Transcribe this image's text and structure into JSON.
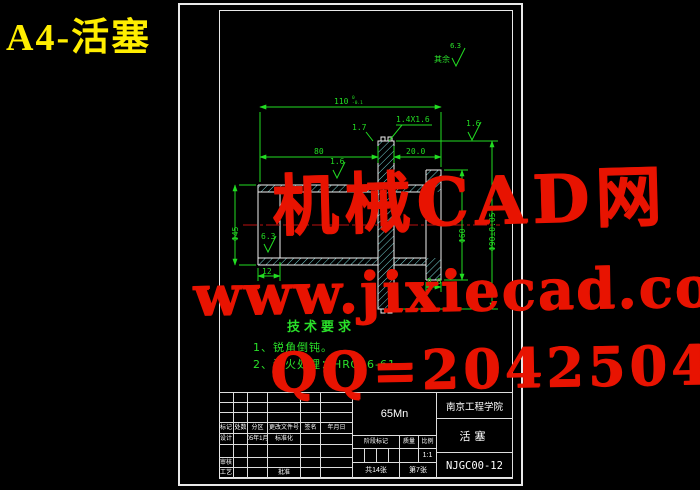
{
  "sheet_label": "A4-活塞",
  "corner_note": {
    "rest_label": "其余",
    "rest_value": "6.3"
  },
  "dimensions": {
    "overall": "110",
    "overall_tol_up": "0",
    "overall_tol_dn": "-0.1",
    "left_length": "80",
    "right_length": "20.0",
    "groove_depth": "1.7",
    "chamfer": "1.4X1.6",
    "od_left": "Φ45",
    "od_right": "Φ60",
    "od_flange": "Φ90±0.05",
    "end_width": "12",
    "ring_width": "8.0",
    "ra_top": "1.6",
    "ra_bore": "6.3",
    "ra_right": "1.6"
  },
  "tech_requirements": {
    "title": "技术要求",
    "items": [
      "1、锐角倒钝。",
      "2、淬火处理：HRC56-61"
    ]
  },
  "watermark": {
    "line1": "机械CAD网",
    "line2": "www.jixiecad.com",
    "line3": "QQ=20425042"
  },
  "title_block": {
    "material": "65Mn",
    "school": "南京工程学院",
    "part_name": "活塞",
    "drawing_no": "NJGC00-12",
    "stage_label": "阶段标记",
    "weight_label": "质量",
    "scale_label": "比例",
    "scale_value": "1:1",
    "sheet_total": "共14张",
    "sheet_index": "第7张",
    "left_table": {
      "header": [
        "标记",
        "处数",
        "分区",
        "更改文件号",
        "签名",
        "年月日"
      ],
      "design": [
        "设计",
        "",
        "05年1月",
        "标准化",
        "",
        ""
      ],
      "review": [
        "审核",
        "",
        "",
        "",
        "",
        ""
      ],
      "process": [
        "工艺",
        "",
        "",
        "批准",
        "",
        ""
      ]
    }
  },
  "colors": {
    "cad_green": "#22dd22",
    "edge_white": "#f0f0f0",
    "hatch_cyan": "#79d6d6",
    "centerline_red": "#bb1111",
    "watermark_red": "#e81301",
    "label_yellow": "#ffee00"
  }
}
